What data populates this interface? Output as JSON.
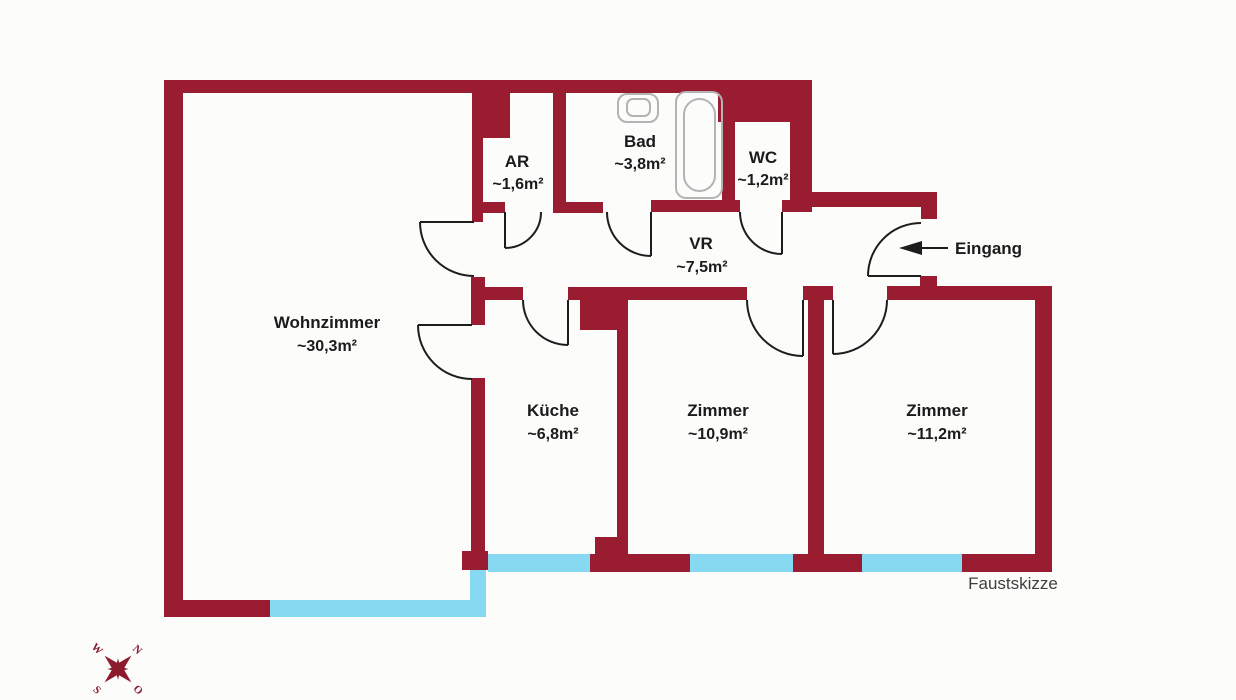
{
  "document": {
    "type": "floor-plan-sketch"
  },
  "colors": {
    "wall": "#9a1c31",
    "window": "#87d9f1",
    "line": "#1d1d1d",
    "fixture": "#b3b3b3",
    "text": "#1b1b1b",
    "muted": "#3f3f3f",
    "compass": "#8c1b2e",
    "background": "#fcfcfb"
  },
  "rooms": {
    "wohnzimmer": {
      "name": "Wohnzimmer",
      "area": "~30,3m²"
    },
    "ar": {
      "name": "AR",
      "area": "~1,6m²"
    },
    "bad": {
      "name": "Bad",
      "area": "~3,8m²"
    },
    "wc": {
      "name": "WC",
      "area": "~1,2m²"
    },
    "vr": {
      "name": "VR",
      "area": "~7,5m²"
    },
    "kueche": {
      "name": "Küche",
      "area": "~6,8m²"
    },
    "zimmer1": {
      "name": "Zimmer",
      "area": "~10,9m²"
    },
    "zimmer2": {
      "name": "Zimmer",
      "area": "~11,2m²"
    }
  },
  "entrance": {
    "label": "Eingang"
  },
  "footer": {
    "label": "Faustskizze"
  },
  "compass": {
    "n": "N",
    "o": "O",
    "s": "S",
    "w": "W"
  },
  "icons": [
    "bathtub-icon",
    "sink-icon",
    "entrance-arrow-icon",
    "compass-rose-icon",
    "door-swing-icon"
  ]
}
